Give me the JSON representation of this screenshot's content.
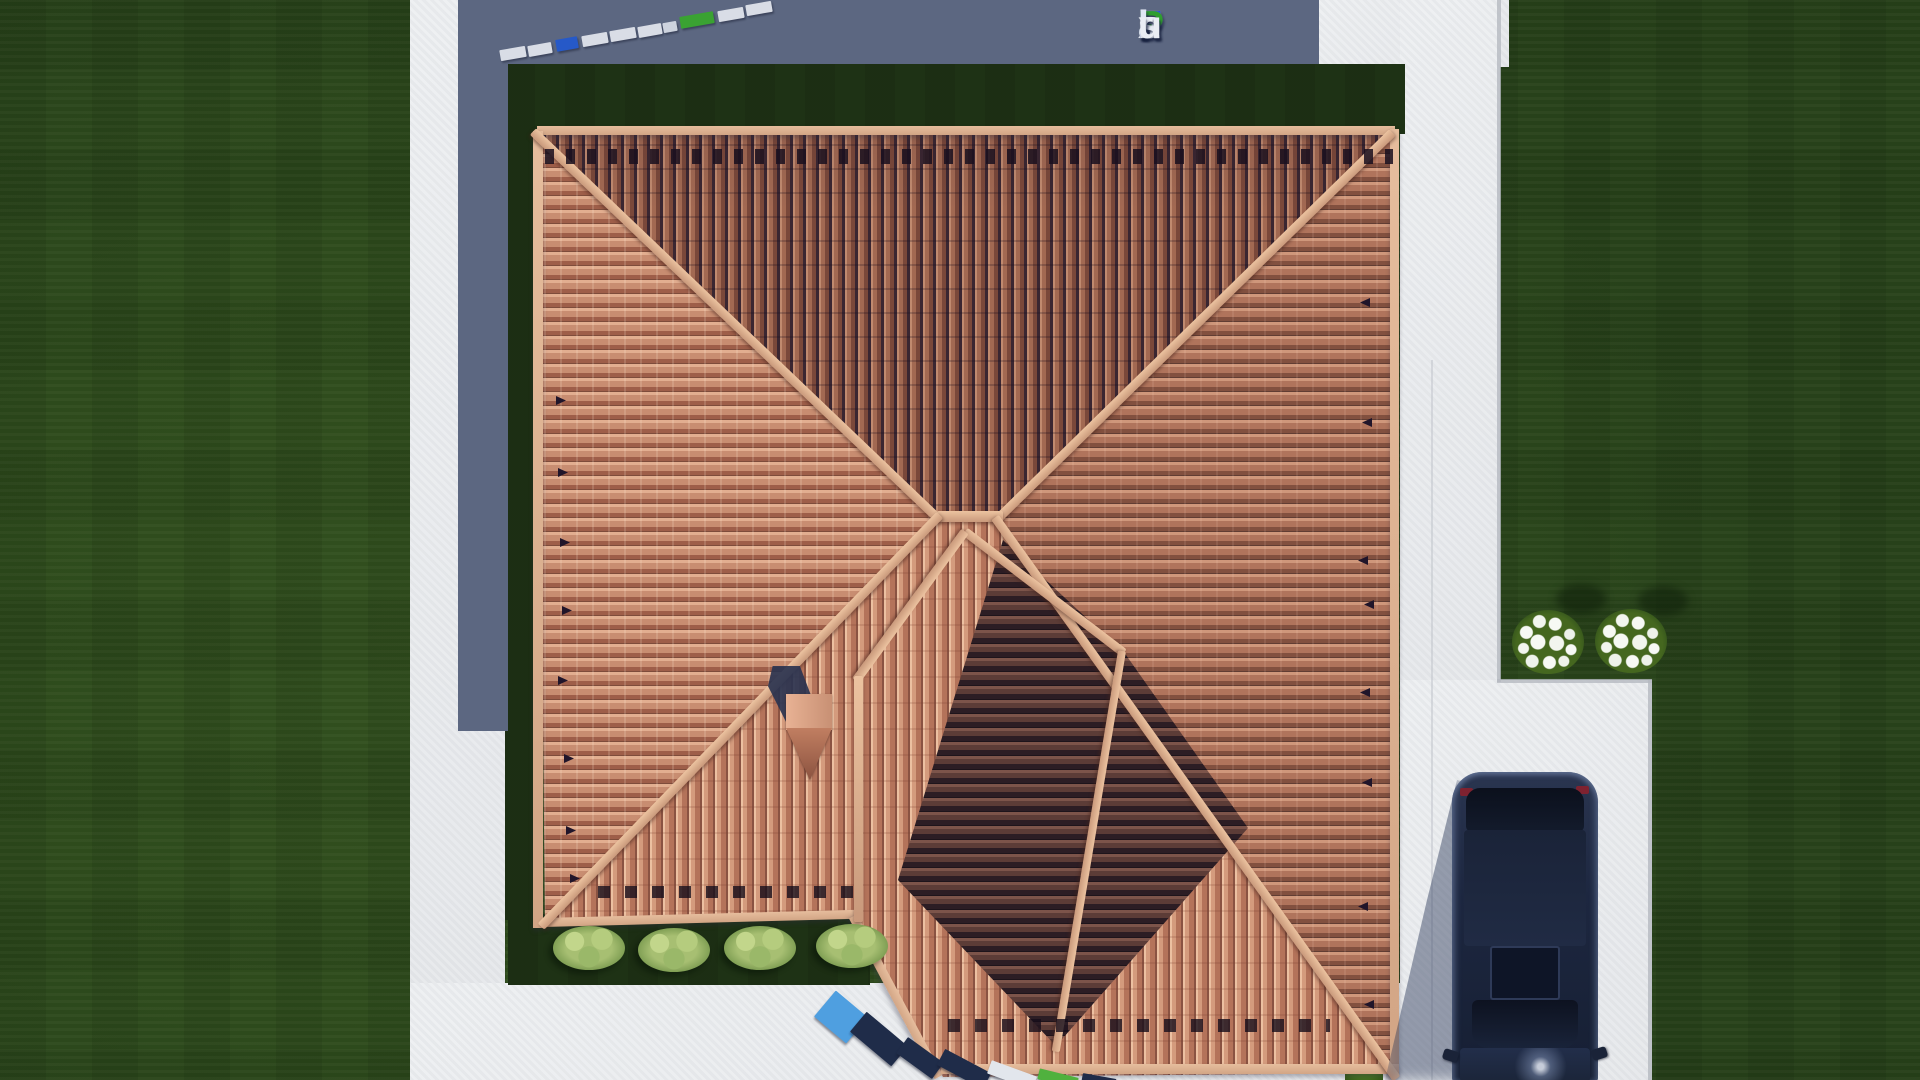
{
  "site": {
    "logo_text": "FixPlans.ru",
    "logo_segments": [
      {
        "t": "F",
        "c": "#2d54cc"
      },
      {
        "t": "i",
        "c": "#e9eef7"
      },
      {
        "t": "x",
        "c": "#e9eef7"
      },
      {
        "t": "P",
        "c": "#2f9e2f"
      },
      {
        "t": "l",
        "c": "#dfe7f4"
      },
      {
        "t": "a",
        "c": "#dfe7f4"
      },
      {
        "t": "n",
        "c": "#dfe7f4"
      },
      {
        "t": "s",
        "c": "#e3e8f1"
      },
      {
        "t": ".",
        "c": "#2d54cc"
      },
      {
        "t": "r",
        "c": "#e9edf4"
      },
      {
        "t": "u",
        "c": "#e9edf4"
      }
    ]
  },
  "palette": {
    "grass": "#2d4a1c",
    "lawn_shadowed": "#1e3215",
    "concrete": "#eef0f2",
    "cast_shadow": "#5c6781",
    "roof_tile_light": "#d49b7d",
    "roof_tile_dark": "#5c3c37",
    "ridge": "#d9a98b",
    "car_body": "#1d2740",
    "chimney_cap": "#d79c7f"
  },
  "watermark_slabs": {
    "top_row": [
      {
        "x": 500,
        "y": 48,
        "w": 26,
        "h": 11,
        "rot": -10,
        "color": "#d9dde6"
      },
      {
        "x": 528,
        "y": 44,
        "w": 24,
        "h": 11,
        "rot": -10,
        "color": "#d9dde6"
      },
      {
        "x": 556,
        "y": 38,
        "w": 22,
        "h": 12,
        "rot": -10,
        "color": "#2659c8"
      },
      {
        "x": 582,
        "y": 34,
        "w": 26,
        "h": 11,
        "rot": -10,
        "color": "#d9dde6"
      },
      {
        "x": 610,
        "y": 29,
        "w": 26,
        "h": 11,
        "rot": -10,
        "color": "#d9dde6"
      },
      {
        "x": 638,
        "y": 25,
        "w": 24,
        "h": 11,
        "rot": -10,
        "color": "#d9dde6"
      },
      {
        "x": 663,
        "y": 22,
        "w": 14,
        "h": 10,
        "rot": -10,
        "color": "#cdd3de"
      },
      {
        "x": 680,
        "y": 14,
        "w": 34,
        "h": 12,
        "rot": -10,
        "color": "#3aa232"
      },
      {
        "x": 718,
        "y": 9,
        "w": 26,
        "h": 11,
        "rot": -10,
        "color": "#d9dde6"
      },
      {
        "x": 746,
        "y": 3,
        "w": 26,
        "h": 11,
        "rot": -10,
        "color": "#d9dde6"
      }
    ],
    "bottom_row": [
      {
        "x": 820,
        "y": 1000,
        "w": 42,
        "h": 34,
        "rot": 40,
        "color": "#4f9fe0"
      },
      {
        "x": 852,
        "y": 1026,
        "w": 54,
        "h": 26,
        "rot": 40,
        "color": "#1f2c49"
      },
      {
        "x": 898,
        "y": 1048,
        "w": 44,
        "h": 20,
        "rot": 36,
        "color": "#1f2c49"
      },
      {
        "x": 938,
        "y": 1060,
        "w": 52,
        "h": 18,
        "rot": 28,
        "color": "#1f2c49"
      },
      {
        "x": 988,
        "y": 1068,
        "w": 48,
        "h": 14,
        "rot": 20,
        "color": "#e2e6ec"
      },
      {
        "x": 1038,
        "y": 1073,
        "w": 40,
        "h": 11,
        "rot": 14,
        "color": "#50b13e"
      },
      {
        "x": 1082,
        "y": 1076,
        "w": 34,
        "h": 8,
        "rot": 10,
        "color": "#1f2c49"
      }
    ]
  },
  "landscape": {
    "bushes": [
      {
        "x": 553,
        "y": 926
      },
      {
        "x": 638,
        "y": 928
      },
      {
        "x": 724,
        "y": 926
      },
      {
        "x": 816,
        "y": 924
      }
    ],
    "flower_clusters": [
      {
        "x": 1512,
        "y": 610
      },
      {
        "x": 1595,
        "y": 609
      }
    ],
    "flower_shadows": [
      {
        "x": 1556,
        "y": 584
      },
      {
        "x": 1638,
        "y": 586
      }
    ]
  },
  "roof": {
    "snow_guards_west": [
      {
        "x": 556,
        "y": 396
      },
      {
        "x": 558,
        "y": 468
      },
      {
        "x": 560,
        "y": 538
      },
      {
        "x": 562,
        "y": 606
      },
      {
        "x": 558,
        "y": 676
      },
      {
        "x": 564,
        "y": 754
      },
      {
        "x": 566,
        "y": 826
      },
      {
        "x": 570,
        "y": 874
      }
    ],
    "snow_guards_east": [
      {
        "x": 1360,
        "y": 298
      },
      {
        "x": 1362,
        "y": 418
      },
      {
        "x": 1358,
        "y": 556
      },
      {
        "x": 1364,
        "y": 600
      },
      {
        "x": 1360,
        "y": 688
      },
      {
        "x": 1362,
        "y": 778
      },
      {
        "x": 1358,
        "y": 902
      },
      {
        "x": 1364,
        "y": 1000
      }
    ]
  }
}
